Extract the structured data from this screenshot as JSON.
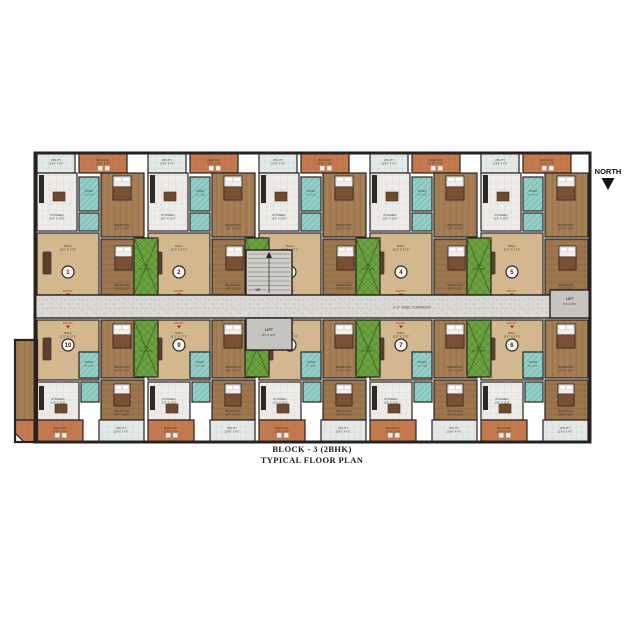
{
  "plan": {
    "caption_line1": "BLOCK - 3 (2BHK)",
    "caption_line2": "TYPICAL FLOOR PLAN",
    "north_label": "NORTH",
    "corridor_label": "4'-6\" WIDE CORRIDOR",
    "entry_label": "ENTRY",
    "up_label": "UP",
    "duct": {
      "name": "OTA",
      "dims": "8'0\" X 12'0\""
    },
    "lift_main": {
      "name": "LIFT",
      "dims": "8'0 X 6'6\""
    },
    "lift_right": {
      "name": "LIFT",
      "dims": "5'0 X 8'0\""
    },
    "room_types": {
      "hall": {
        "name": "HALL",
        "dims": "11'0\" X 17'0\""
      },
      "kitchen": {
        "name": "KITCHEN",
        "dims": "11'0\" X 12'0\""
      },
      "bedroom": {
        "name": "BEDROOM",
        "dims": "11'0\" X 12'0\""
      },
      "bedroom2": {
        "name": "BEDROOM",
        "dims": "11'4\" X 11'0\""
      },
      "toilet": {
        "name": "TOILET",
        "dims": "7'0\" X 4'6\""
      },
      "balcony": {
        "name": "BALCONY",
        "dims": "11'6½\" X 4'6\""
      },
      "utility": {
        "name": "UTILITY",
        "dims": "11'6½\" X 4'0\""
      }
    },
    "units_top": [
      "1",
      "2",
      "3",
      "4",
      "5"
    ],
    "units_bottom": [
      "10",
      "9",
      "8",
      "7",
      "6"
    ],
    "colors": {
      "wall": "#272220",
      "hall_floor": "#d3b88f",
      "wood": "#a37c53",
      "wood_dark": "#9a744c",
      "tile": "#ecebe7",
      "utility_tile": "#e3e9e6",
      "toilet_teal": "#93cfc7",
      "balcony_orange": "#c4794e",
      "duct_green": "#6ca341",
      "corridor_gray": "#dbd9d5",
      "lift_gray": "#c6c4c0",
      "entry_red": "#a8281e"
    }
  }
}
